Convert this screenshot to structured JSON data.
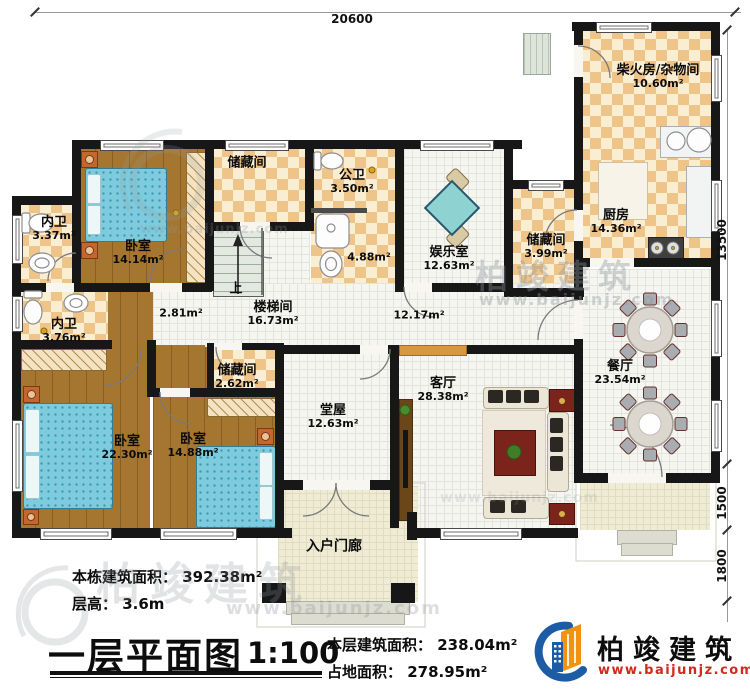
{
  "dimensions": {
    "top": "20600",
    "right_main": "13500",
    "right_mid": "1500",
    "right_bottom": "1800"
  },
  "rooms": {
    "chai": {
      "name": "柴火房/杂物间",
      "area": "10.60m²"
    },
    "kitchen": {
      "name": "厨房",
      "area": "14.36m²"
    },
    "storage_k": {
      "name": "储藏间",
      "area": "3.99m²"
    },
    "dining": {
      "name": "餐厅",
      "area": "23.54m²"
    },
    "ent": {
      "name": "娱乐室",
      "area": "12.63m²"
    },
    "pub_wc": {
      "name": "公卫",
      "area": "3.50m²"
    },
    "wash": {
      "area": "4.88m²"
    },
    "storage_top": {
      "name": "储藏间"
    },
    "bed1": {
      "name": "卧室",
      "area": "14.14m²"
    },
    "wc1": {
      "name": "内卫",
      "area": "3.37m²"
    },
    "wc2": {
      "name": "内卫",
      "area": "3.76m²"
    },
    "stair": {
      "name": "楼梯间",
      "area": "16.73m²",
      "up": "上"
    },
    "hall1": {
      "area": "2.81m²"
    },
    "hall2": {
      "area": "12.17m²"
    },
    "storage_s": {
      "name": "储藏间",
      "area": "2.62m²"
    },
    "tangwu": {
      "name": "堂屋",
      "area": "12.63m²"
    },
    "living": {
      "name": "客厅",
      "area": "28.38m²"
    },
    "bed2": {
      "name": "卧室",
      "area": "22.30m²"
    },
    "bed3": {
      "name": "卧室",
      "area": "14.88m²"
    },
    "porch": {
      "name": "入户门廊"
    }
  },
  "titleblock": {
    "building_area": "本栋建筑面积： 392.38m²",
    "floor_height": "层高： 3.6m",
    "plan_title": "一层平面图",
    "scale": "1:100",
    "floor_area": "本层建筑面积： 238.04m²",
    "footprint": "占地面积： 278.95m²"
  },
  "logo": {
    "company": "柏竣建筑",
    "website": "www.baijunjz.com"
  },
  "watermark": {
    "brand": "柏竣建筑",
    "site": "www.baijunjz.com"
  }
}
